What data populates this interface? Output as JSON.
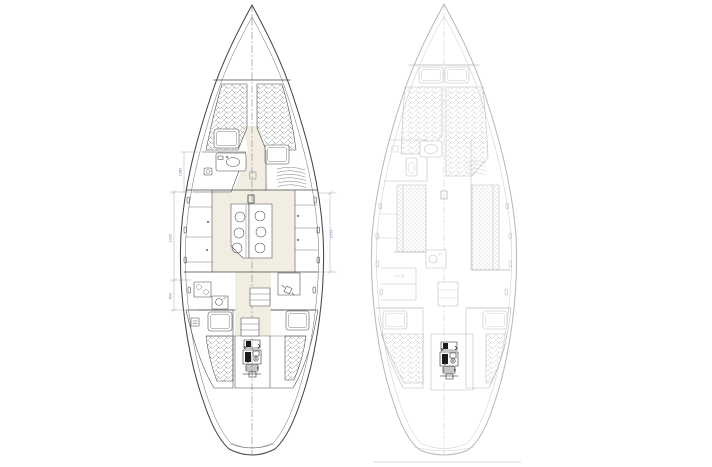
{
  "colors": {
    "bg": "#ffffff",
    "line-dark": "#46464e",
    "line-light": "#b9b9bf",
    "hatch-dark": "#92929b",
    "hatch-light": "#c9c9cf",
    "sole": "#f1eee1",
    "dim-line": "#9a9aa2",
    "dim-text": "#6a6ab8",
    "engine-dark": "#1b1b1f"
  },
  "left_plan": {
    "features": [
      "bow",
      "v-berth",
      "berth-pillows",
      "head-with-sink",
      "hanging-locker",
      "salon",
      "folding-table-with-six-settings",
      "galley-stove-sink",
      "nav-station-with-seat",
      "companionway-steps",
      "port-quarter-berth",
      "starboard-quarter-berth",
      "engine",
      "transom"
    ],
    "dimension_labels": [
      {
        "id": "head-length",
        "text": "1980"
      },
      {
        "id": "salon-length-port",
        "text": "2000"
      },
      {
        "id": "galley-length-port",
        "text": "850"
      },
      {
        "id": "salon-length-starboard",
        "text": "2070"
      }
    ]
  },
  "right_plan": {
    "features": [
      "bow",
      "v-berth",
      "berth-pillows",
      "head-with-toilet-and-sink",
      "port-settee",
      "starboard-settee",
      "galley-sink",
      "lockers",
      "companionway-steps",
      "port-quarter-berth",
      "starboard-quarter-berth",
      "engine",
      "transom",
      "baseline"
    ]
  }
}
